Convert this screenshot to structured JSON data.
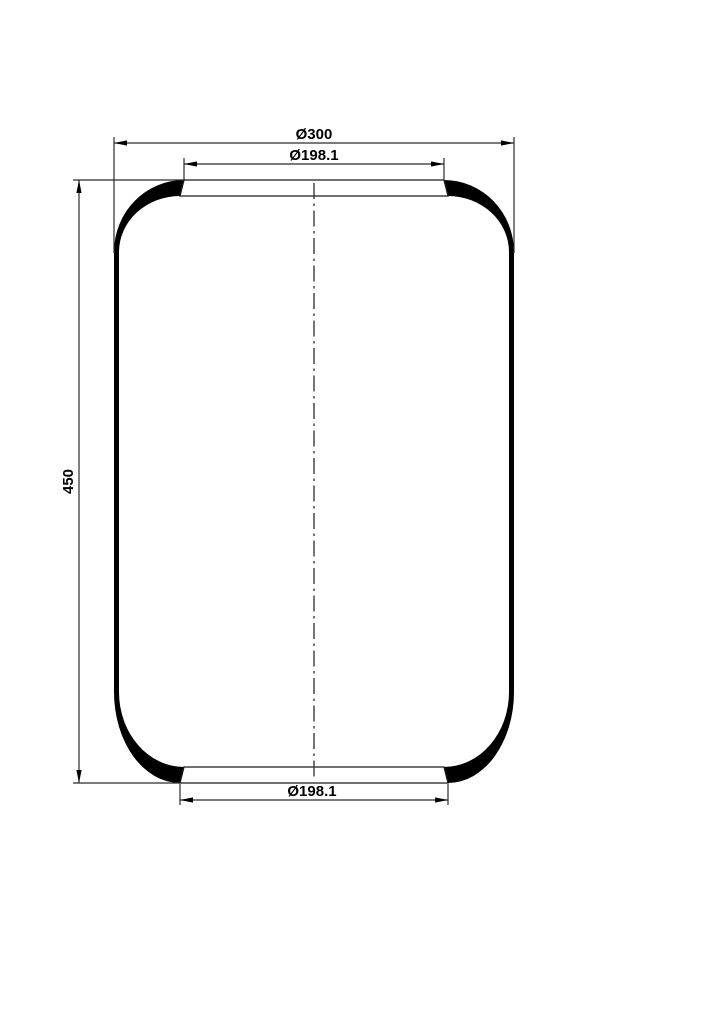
{
  "drawing": {
    "type": "technical-drawing",
    "part": "air-spring-bellows",
    "outer_diameter_label": "Ø300",
    "top_bead_diameter_label": "Ø198.1",
    "height_label": "450",
    "bottom_bead_diameter_label": "Ø198.1"
  },
  "colors": {
    "background": "#ffffff",
    "ink": "#000000",
    "thin_line": "#2b2b2b",
    "rim_outline": "#1a1a1a",
    "centerline": "#3a3a3a"
  }
}
